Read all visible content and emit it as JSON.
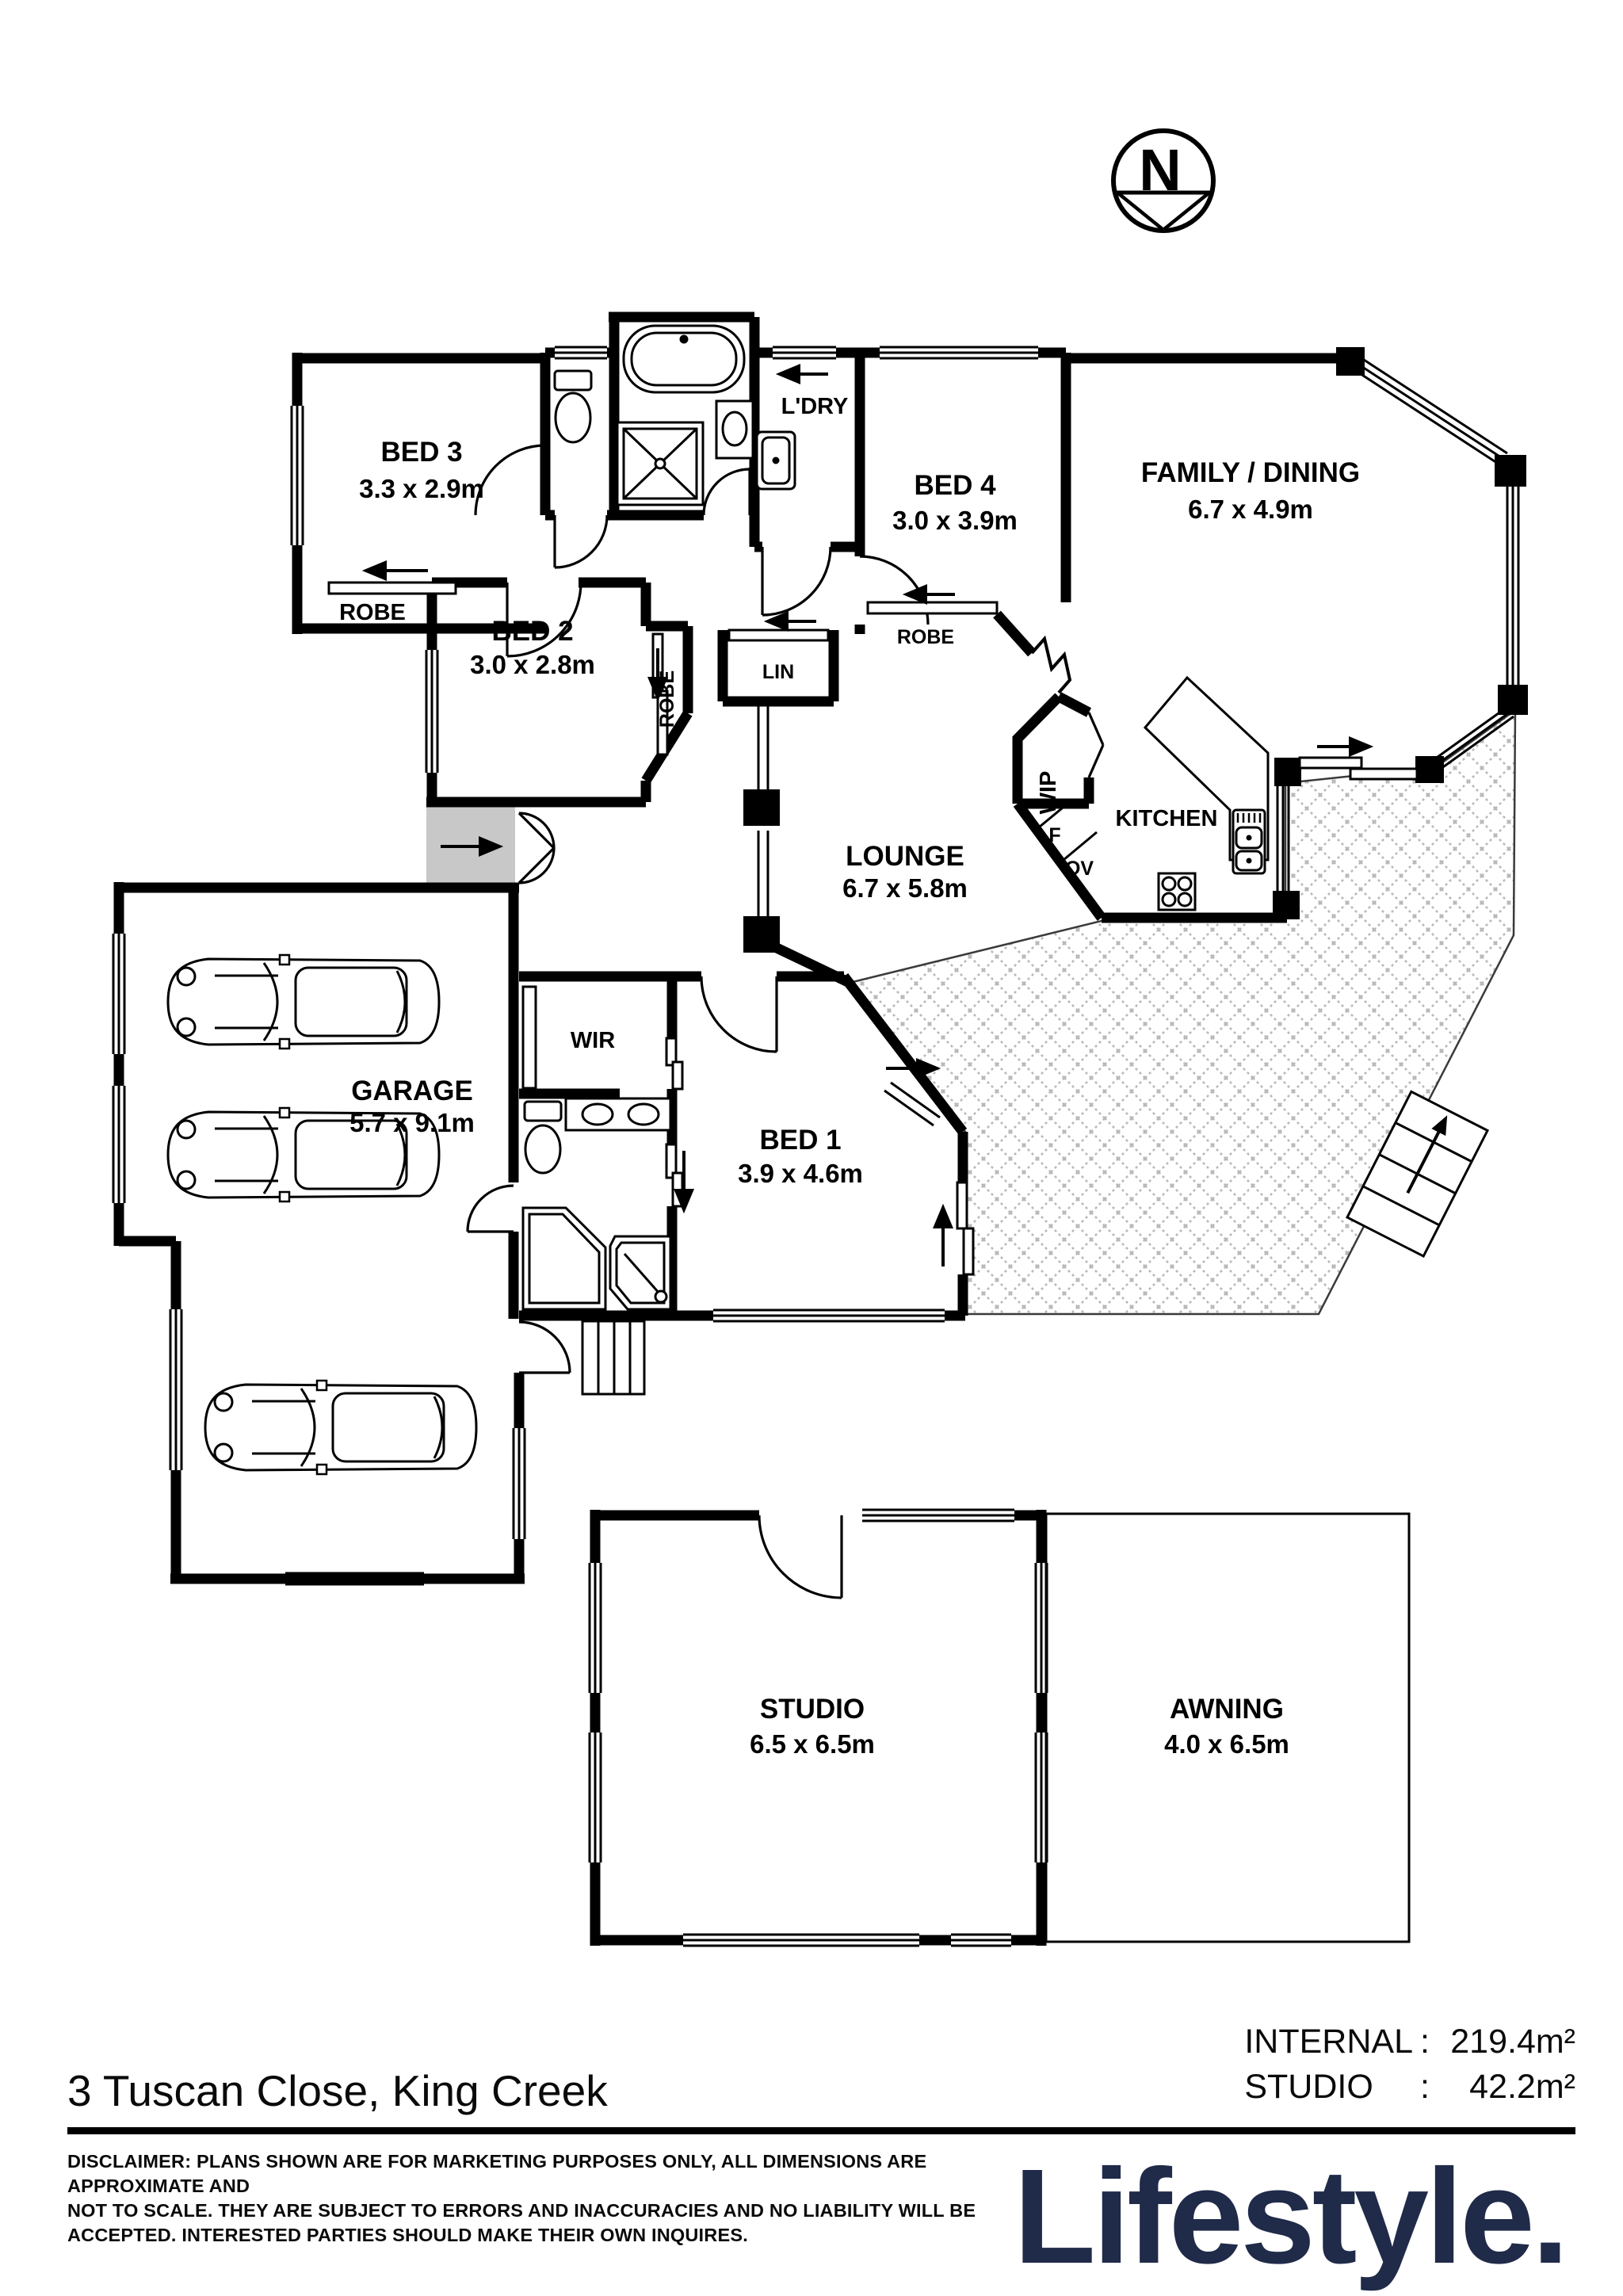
{
  "compass": {
    "north_letter": "N"
  },
  "rooms": {
    "bed3": {
      "label": "BED 3",
      "dims": "3.3 x 2.9m"
    },
    "bed2": {
      "label": "BED 2",
      "dims": "3.0 x 2.8m"
    },
    "bed4": {
      "label": "BED 4",
      "dims": "3.0 x 3.9m"
    },
    "family": {
      "label": "FAMILY / DINING",
      "dims": "6.7 x 4.9m"
    },
    "lounge": {
      "label": "LOUNGE",
      "dims": "6.7 x 5.8m"
    },
    "bed1": {
      "label": "BED 1",
      "dims": "3.9 x 4.6m"
    },
    "garage": {
      "label": "GARAGE",
      "dims": "5.7 x 9.1m"
    },
    "studio": {
      "label": "STUDIO",
      "dims": "6.5 x 6.5m"
    },
    "awning": {
      "label": "AWNING",
      "dims": "4.0 x 6.5m"
    },
    "kitchen": {
      "label": "KITCHEN"
    },
    "ldry": {
      "label": "L'DRY"
    },
    "wip": {
      "label": "WIP"
    },
    "wir": {
      "label": "WIR"
    },
    "lin": {
      "label": "LIN"
    },
    "robe_bed3": {
      "label": "ROBE"
    },
    "robe_bed4": {
      "label": "ROBE"
    },
    "robe_bed2": {
      "label": "ROBE"
    },
    "fridge": {
      "label": "F"
    },
    "oven": {
      "label": "OV"
    }
  },
  "footer": {
    "address": "3 Tuscan Close, King Creek",
    "areas": [
      {
        "label": "INTERNAL",
        "colon": ":",
        "value": "219.4m²"
      },
      {
        "label": "STUDIO",
        "colon": ":",
        "value": "42.2m²"
      }
    ],
    "disclaimer": "DISCLAIMER: PLANS SHOWN ARE FOR MARKETING PURPOSES ONLY, ALL DIMENSIONS ARE APPROXIMATE AND\nNOT  TO SCALE. THEY  ARE SUBJECT  TO ERRORS AND INACCURACIES  AND NO LIABILITY  WILL  BE\nACCEPTED. INTERESTED PARTIES SHOULD MAKE THEIR OWN INQUIRES.",
    "brand": "Lifestyle."
  },
  "colors": {
    "brand_navy": "#202a49",
    "hatch_gray": "#b9b9b9",
    "porch_gray": "#c8c8c8"
  }
}
